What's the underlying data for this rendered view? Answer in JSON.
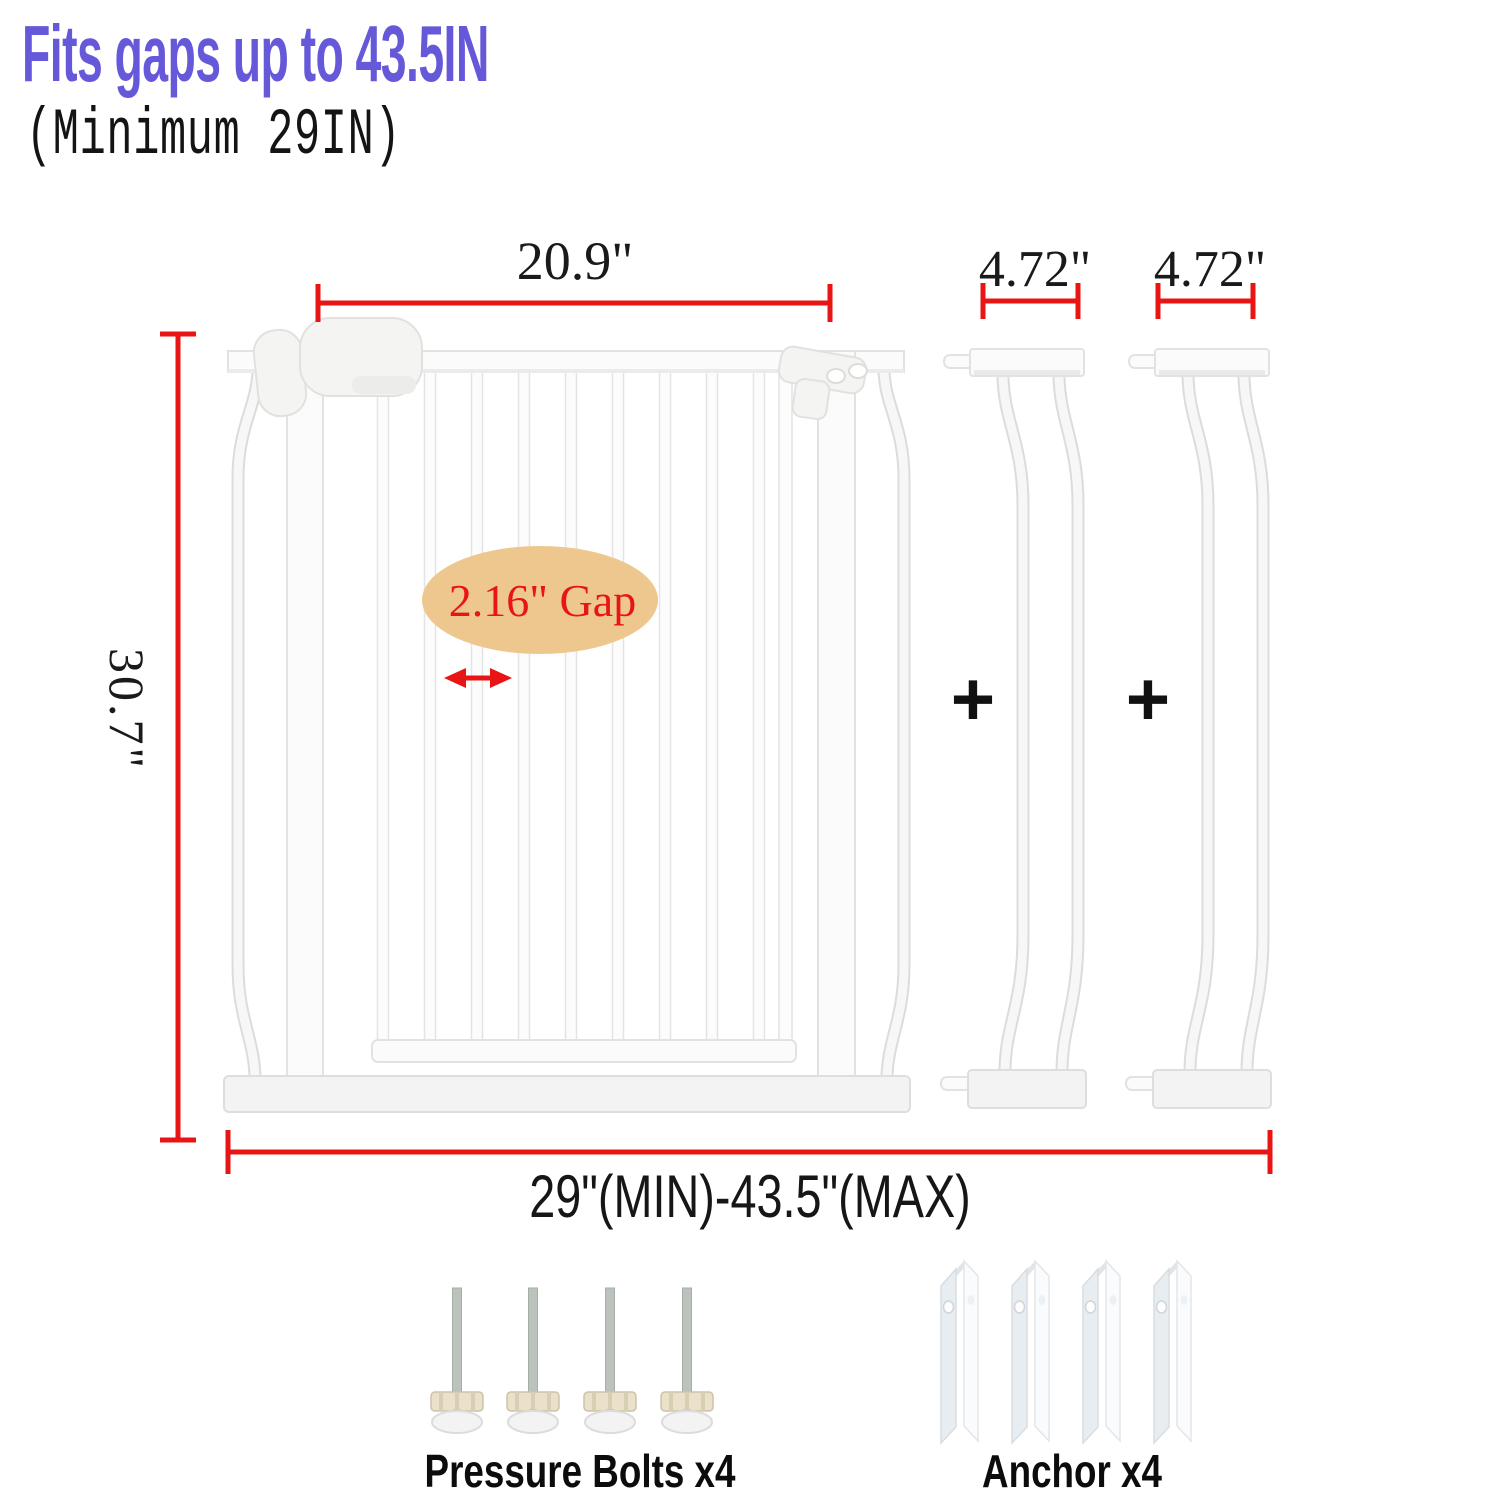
{
  "header": {
    "title": "Fits gaps up to 43.5IN",
    "subtitle": "(Minimum 29IN)"
  },
  "dimensions": {
    "door_width": "20.9\"",
    "extension_width_1": "4.72\"",
    "extension_width_2": "4.72\"",
    "gate_height": "30.7\"",
    "fit_range": "29\"(MIN)-43.5\"(MAX)",
    "bar_gap": "2.16\" Gap"
  },
  "operators": {
    "plus_1": "+",
    "plus_2": "+"
  },
  "included_parts": {
    "pressure_bolts": "Pressure Bolts x4",
    "anchors": "Anchor x4"
  },
  "colors": {
    "title_purple": "#6659d9",
    "dimension_red": "#e91414",
    "gap_highlight_tan": "#edc78e"
  }
}
